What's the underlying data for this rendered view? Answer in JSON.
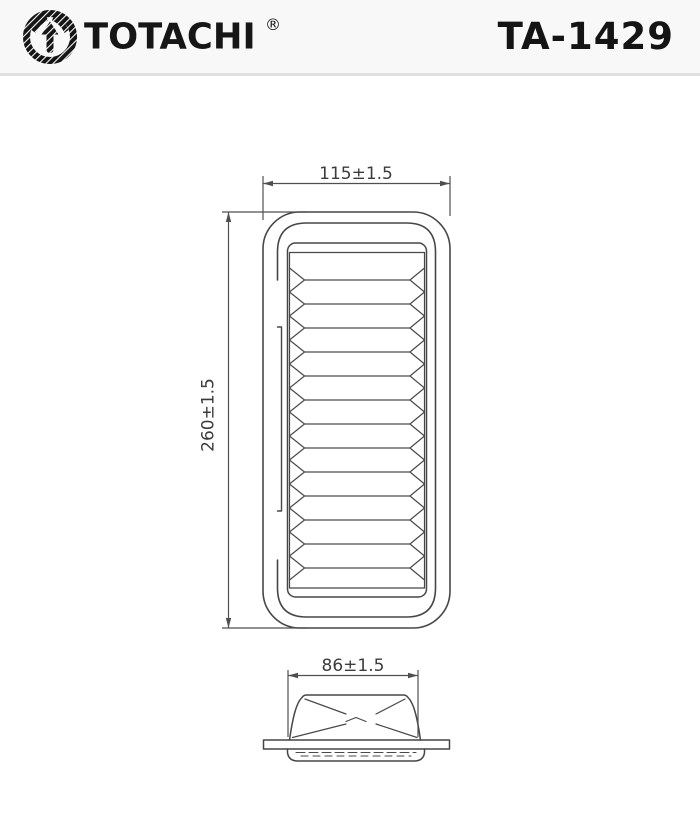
{
  "header": {
    "brand": "TOTACHI",
    "registered": "®",
    "part_number": "TA-1429"
  },
  "drawing": {
    "top_view": {
      "width_dim": "115±1.5",
      "height_dim": "260±1.5",
      "pleat_count": 13
    },
    "side_view": {
      "width_dim": "86±1.5"
    }
  },
  "colors": {
    "header_bg": "#f8f8f8",
    "header_border": "#e0e0e0",
    "ink": "#141414",
    "line": "#474747",
    "dim_line": "#4f4f4f",
    "dim_text": "#3c3c3c"
  }
}
